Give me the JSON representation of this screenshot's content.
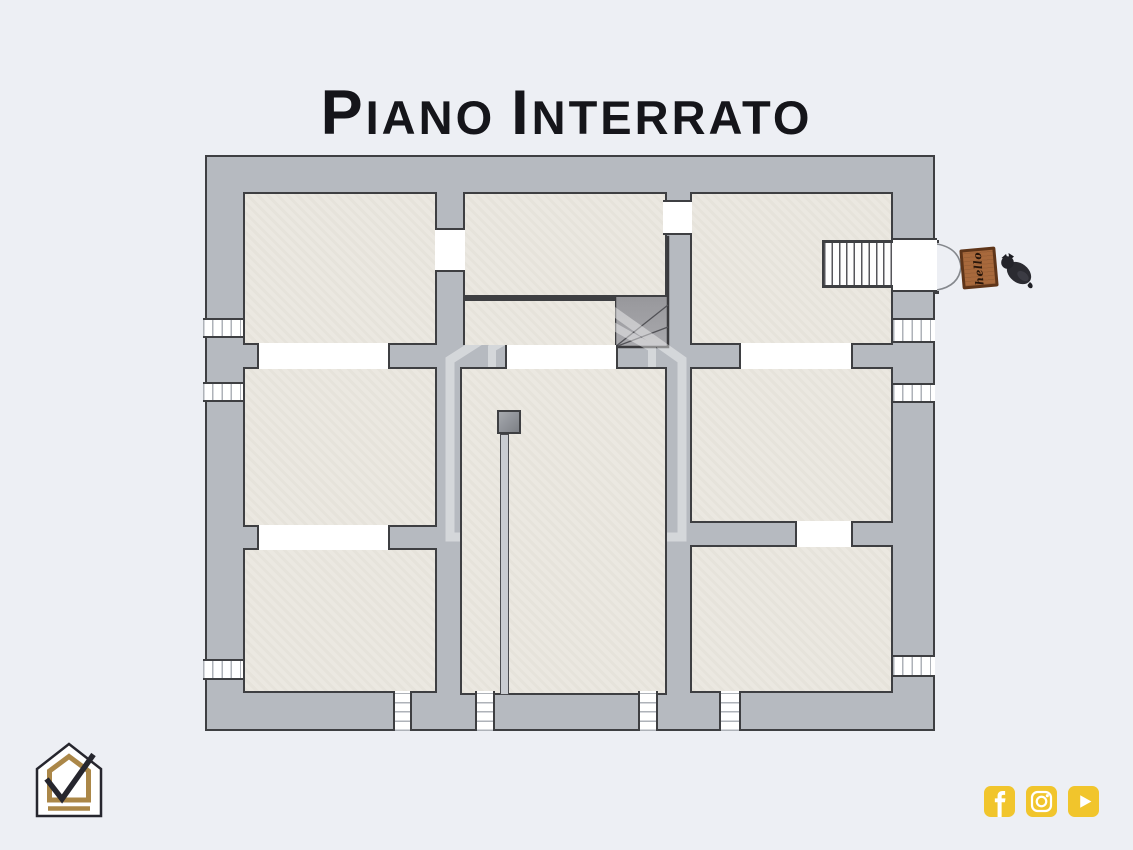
{
  "page": {
    "background": "#edeff4",
    "width": 1133,
    "height": 850
  },
  "title": {
    "text": "Piano Interrato",
    "color": "#15151a",
    "parts": [
      {
        "big": "P",
        "rest": "IANO"
      },
      {
        "big": "I",
        "rest": "NTERRATO"
      }
    ]
  },
  "floor_plan": {
    "container": {
      "x": 205,
      "y": 155,
      "w": 730,
      "h": 576
    },
    "colors": {
      "wall": "#b6bac0",
      "room": "#ebe8e1",
      "line": "#3e3f42",
      "opening": "#ffffff",
      "stair_dark": "#77777b",
      "stair_light": "#a9a9ad"
    },
    "rooms": [
      {
        "name": "room-top-left",
        "x": 243,
        "y": 192,
        "w": 194,
        "h": 153
      },
      {
        "name": "room-top-middle",
        "x": 463,
        "y": 192,
        "w": 204,
        "h": 105
      },
      {
        "name": "stair-landing",
        "x": 463,
        "y": 297,
        "w": 152,
        "h": 48,
        "variant": "landing"
      },
      {
        "name": "room-top-right",
        "x": 690,
        "y": 192,
        "w": 203,
        "h": 153
      },
      {
        "name": "room-mid-left",
        "x": 243,
        "y": 367,
        "w": 194,
        "h": 160
      },
      {
        "name": "room-central",
        "x": 460,
        "y": 367,
        "w": 207,
        "h": 328
      },
      {
        "name": "room-mid-right",
        "x": 690,
        "y": 367,
        "w": 203,
        "h": 156
      },
      {
        "name": "room-bottom-left",
        "x": 243,
        "y": 548,
        "w": 194,
        "h": 145
      },
      {
        "name": "room-bottom-right",
        "x": 690,
        "y": 545,
        "w": 203,
        "h": 148
      }
    ],
    "doors": [
      {
        "name": "door-topleft-topmiddle",
        "x": 435,
        "y": 228,
        "w": 30,
        "h": 44,
        "orient": "v"
      },
      {
        "name": "door-topmiddle-topright",
        "x": 663,
        "y": 200,
        "w": 29,
        "h": 35,
        "orient": "v"
      },
      {
        "name": "door-topleft-midleft",
        "x": 257,
        "y": 343,
        "w": 133,
        "h": 26,
        "orient": "h"
      },
      {
        "name": "opening-landing-central",
        "x": 505,
        "y": 345,
        "w": 113,
        "h": 24,
        "orient": "h"
      },
      {
        "name": "door-topright-midright",
        "x": 739,
        "y": 343,
        "w": 114,
        "h": 26,
        "orient": "h"
      },
      {
        "name": "door-midleft-bottomleft",
        "x": 257,
        "y": 525,
        "w": 133,
        "h": 25,
        "orient": "h"
      },
      {
        "name": "door-midright-bottomright",
        "x": 795,
        "y": 521,
        "w": 58,
        "h": 26,
        "orient": "h"
      }
    ],
    "entrance": {
      "name": "entrance-opening",
      "x": 893,
      "y": 238,
      "w": 44,
      "h": 54,
      "orient": "v"
    },
    "windows": [
      {
        "name": "window-left-1",
        "x": 203,
        "y": 318,
        "w": 40,
        "h": 20,
        "orient": "v"
      },
      {
        "name": "window-left-2",
        "x": 203,
        "y": 382,
        "w": 40,
        "h": 20,
        "orient": "v"
      },
      {
        "name": "window-left-3",
        "x": 203,
        "y": 659,
        "w": 40,
        "h": 21,
        "orient": "v"
      },
      {
        "name": "window-right-1",
        "x": 893,
        "y": 318,
        "w": 42,
        "h": 25,
        "orient": "v"
      },
      {
        "name": "window-right-2",
        "x": 893,
        "y": 383,
        "w": 42,
        "h": 20,
        "orient": "v"
      },
      {
        "name": "window-right-3",
        "x": 893,
        "y": 655,
        "w": 42,
        "h": 22,
        "orient": "v"
      },
      {
        "name": "window-bottom-1",
        "x": 393,
        "y": 691,
        "w": 19,
        "h": 40,
        "orient": "h"
      },
      {
        "name": "window-bottom-2",
        "x": 475,
        "y": 691,
        "w": 20,
        "h": 40,
        "orient": "h"
      },
      {
        "name": "window-bottom-3",
        "x": 638,
        "y": 691,
        "w": 20,
        "h": 40,
        "orient": "h"
      },
      {
        "name": "window-bottom-4",
        "x": 719,
        "y": 691,
        "w": 22,
        "h": 40,
        "orient": "h"
      }
    ],
    "straight_stair": {
      "name": "entrance-stair",
      "x": 822,
      "y": 240,
      "w": 71,
      "h": 48
    },
    "l_stair": {
      "name": "winder-stair",
      "x": 555,
      "y": 235,
      "w": 115,
      "h": 115
    },
    "pillar": {
      "x": 497,
      "y": 410,
      "w": 24,
      "h": 24
    },
    "flue": {
      "x": 500,
      "y": 434,
      "w": 9,
      "h": 261
    },
    "entrance_doors": {
      "x": 893,
      "y": 236,
      "w": 78,
      "h": 62
    },
    "doormat": {
      "label": "hello",
      "x": 961,
      "y": 248,
      "w": 36,
      "h": 40,
      "fill": "#a8693c",
      "border": "#5f3519",
      "text_color": "#27150a"
    },
    "dog": {
      "x": 997,
      "y": 247,
      "w": 42,
      "h": 46
    }
  },
  "watermark": {
    "x": 438,
    "y": 270,
    "w": 256,
    "h": 278,
    "opacity": 0.42,
    "color": "#ffffff"
  },
  "branding": {
    "logo": {
      "name": "house-check-logo",
      "x": 34,
      "y": 741,
      "w": 70,
      "h": 78,
      "gold": "#ab8748",
      "dark": "#26262e"
    },
    "social": {
      "x": 984,
      "y": 786,
      "size": 31,
      "gap": 11,
      "color": "#f1c52c",
      "items": [
        {
          "name": "facebook"
        },
        {
          "name": "instagram"
        },
        {
          "name": "youtube"
        }
      ]
    }
  }
}
